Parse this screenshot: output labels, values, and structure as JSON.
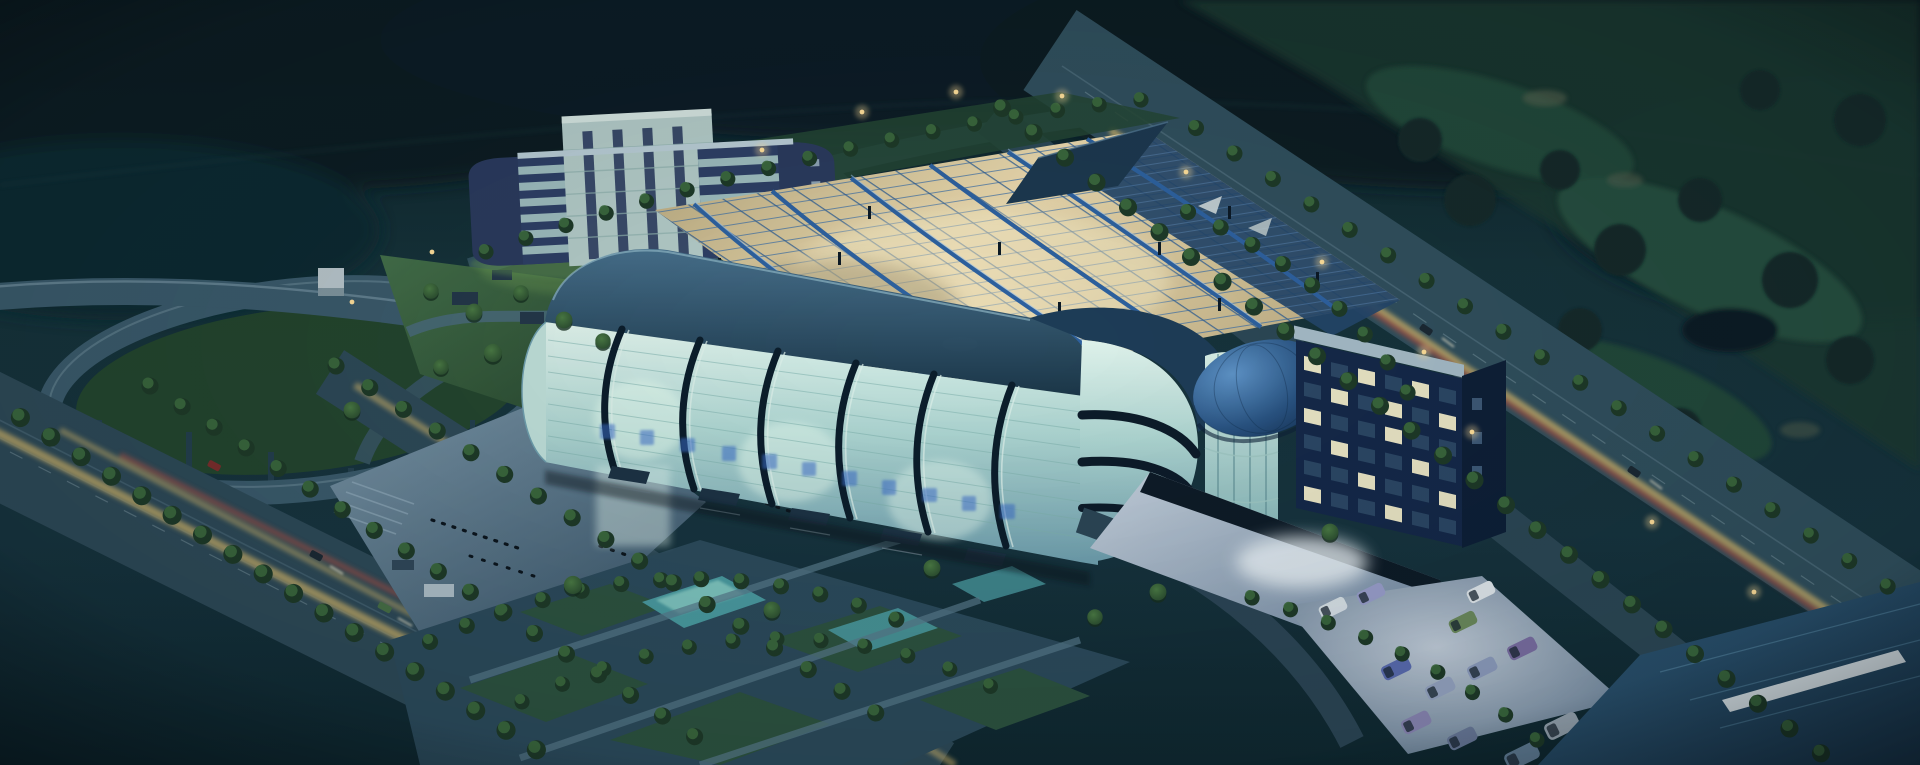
{
  "meta": {
    "title": "Aerial dusk rendering of a glass exhibition and convention center complex with highway interchange, tree-lined boulevards and parking lots",
    "type": "architectural-rendering",
    "time_of_day": "dusk"
  },
  "palette": {
    "sky_forest": "#122a30",
    "golf_green": "#1c3a33",
    "road": "#31505e",
    "road_edge": "#6d8a99",
    "tree_dark": "#1e3a28",
    "tree_leaf": "#3c6b3f",
    "lawn": "#2f5540",
    "plaza_lit": "#7c98aa",
    "glass": "#aed6d2",
    "roof_steel": "#2f4f66",
    "truss_blue": "#2e62a0",
    "truss_warm": "#e9ddb2",
    "dome_blue": "#2a5584",
    "office_navy": "#2e4066",
    "office_pale": "#b3cbc8",
    "window_lit": "#eae6c6",
    "pond": "#4a9aa0",
    "pavement_lit": "#aebfd0"
  },
  "lighting": {
    "street_lamp": "#ffdf9a",
    "interior_glow": "#e9ddb2",
    "trail_yellow": "#c9b06a",
    "trail_red": "#a84e44",
    "white_glow": "#eef6fa"
  },
  "signage": {
    "present": true,
    "script": "blue character band on glass facade (illegible at this scale)",
    "color": "#3a6cc8"
  },
  "vehicles": {
    "van_colors": [
      "#d8e2e8",
      "#9aa0cc",
      "#6d8c5e",
      "#e2e9ee",
      "#5b6db2",
      "#97a6c4",
      "#8f9ec0",
      "#7b6fa4",
      "#8a86b4",
      "#6a7a9a",
      "#5e7293"
    ],
    "bus_colors": [
      "#9aa8b4",
      "#7e89a8",
      "#64819a"
    ],
    "car_body": "#1c2a34"
  }
}
